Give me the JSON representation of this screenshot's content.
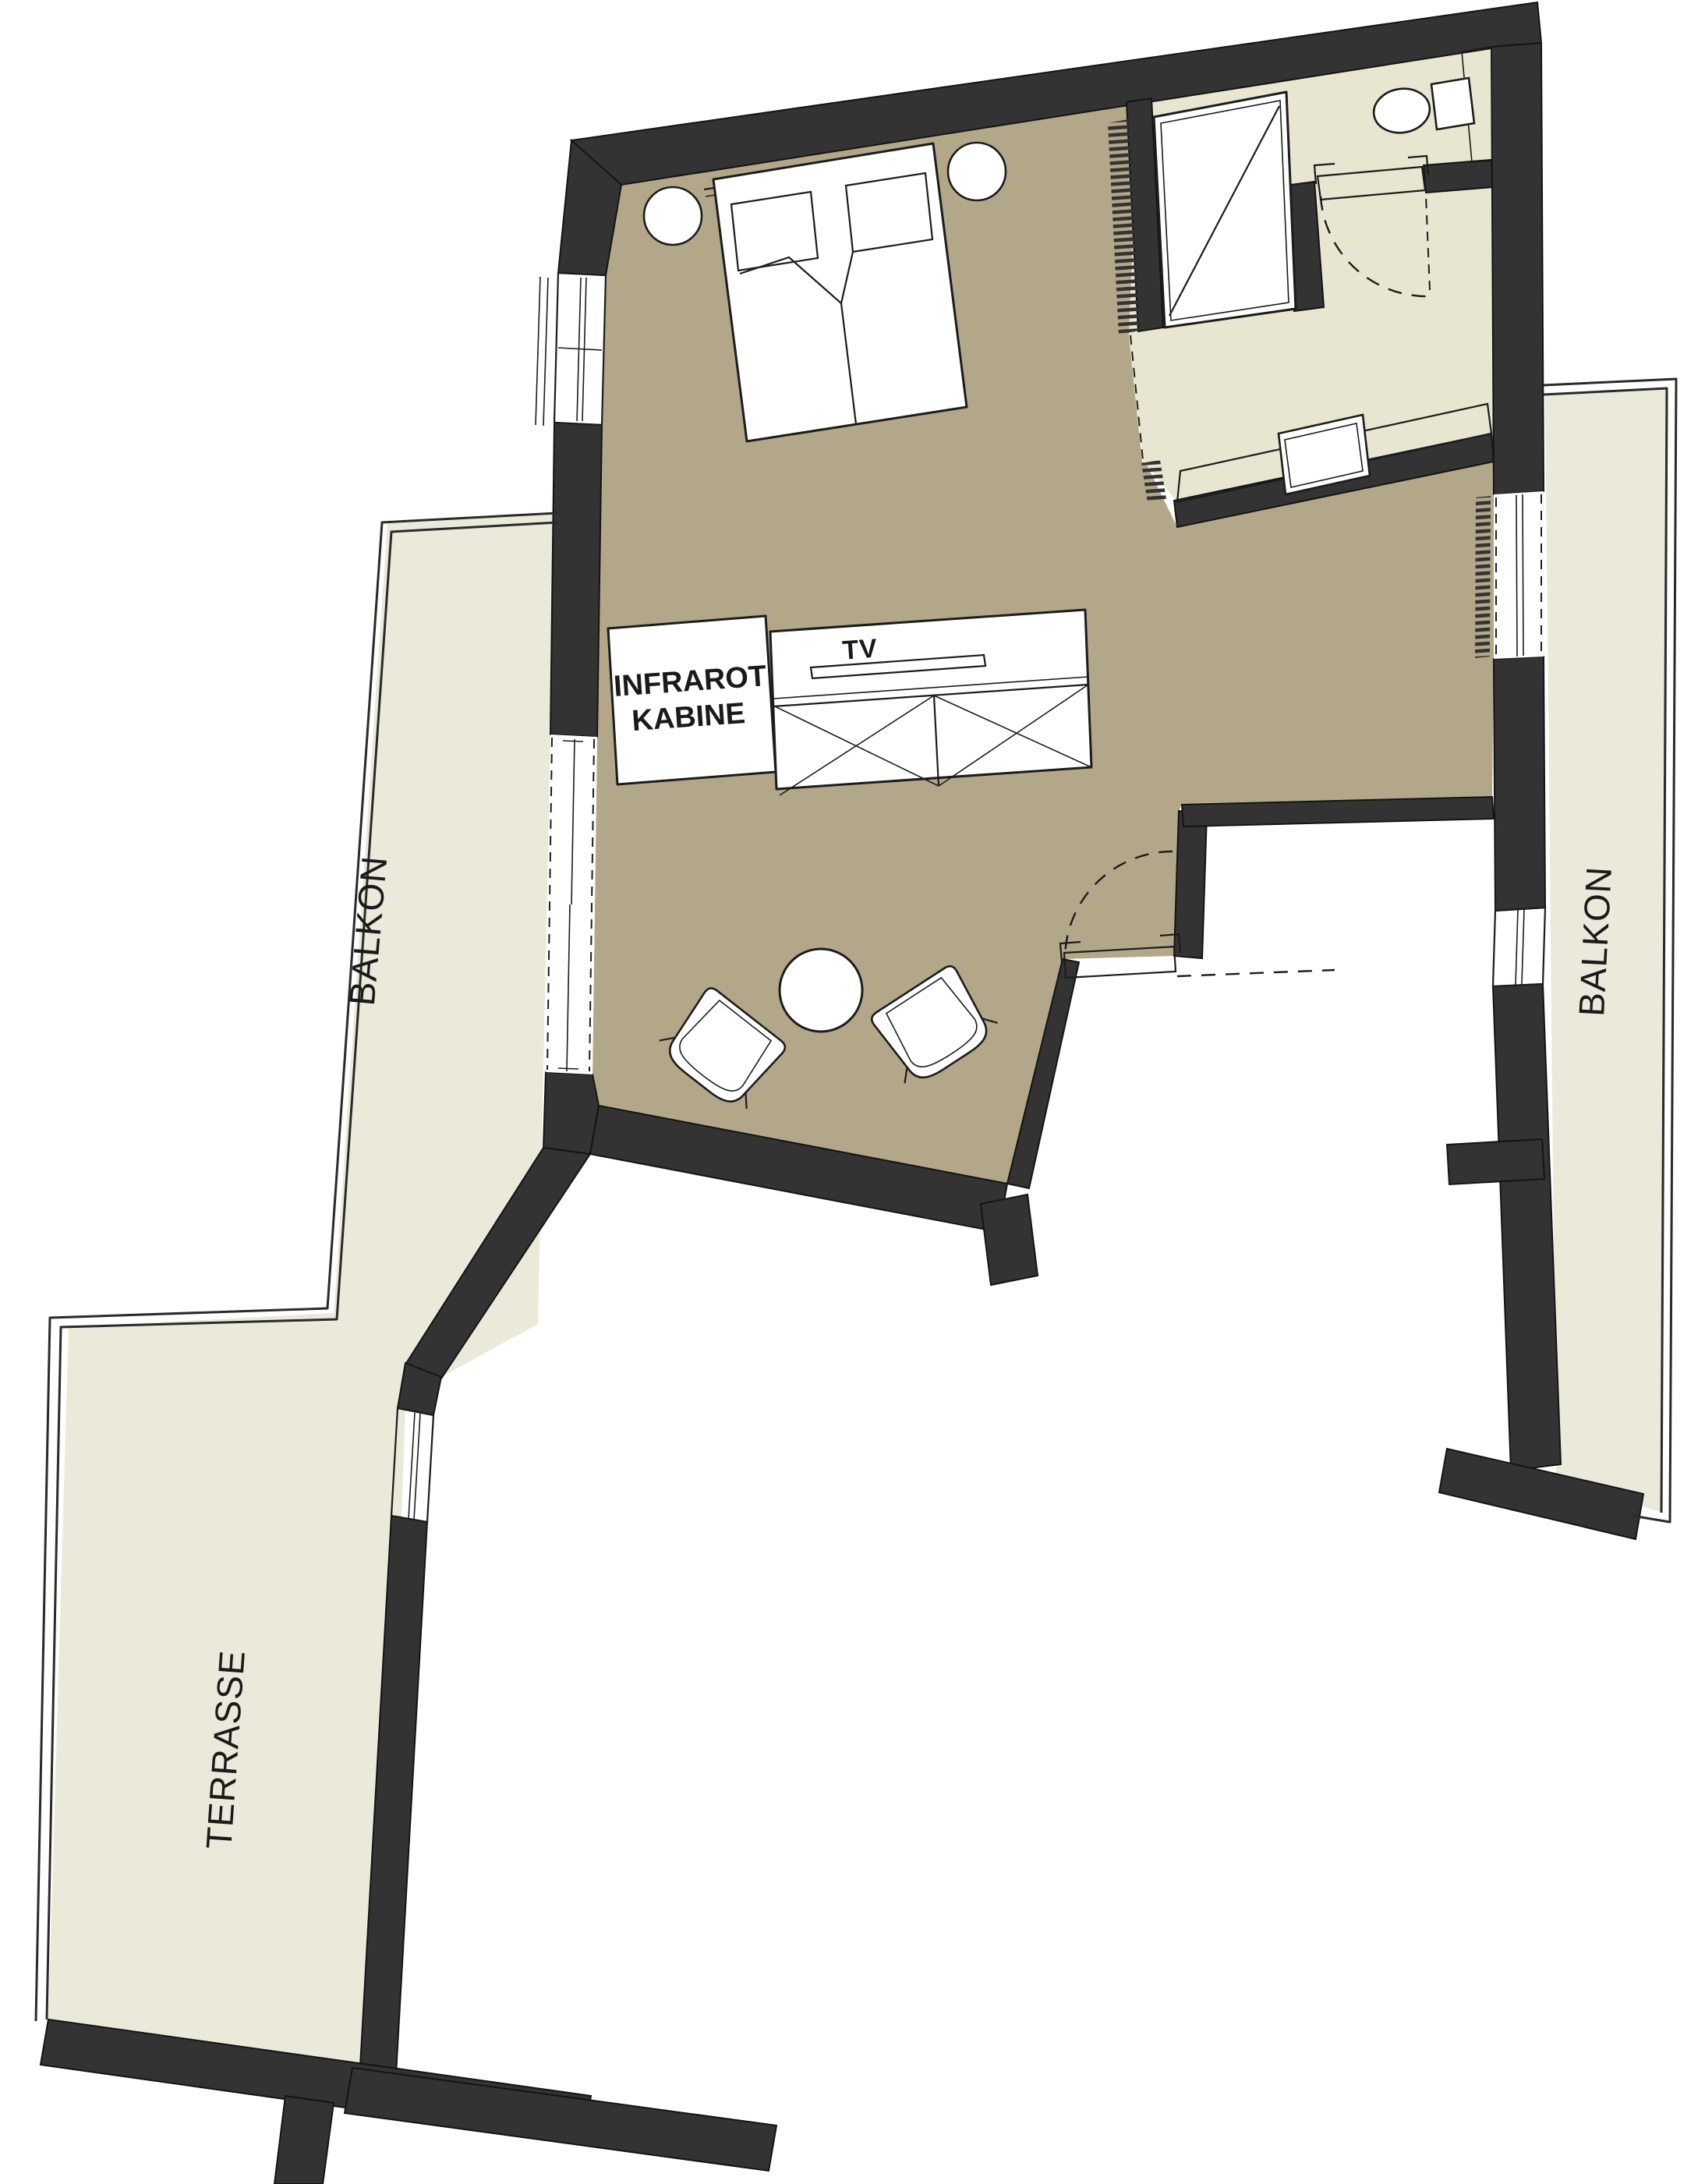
{
  "page": {
    "background": "#ffffff",
    "type": "architectural-floor-plan"
  },
  "colors": {
    "wall": "#333333",
    "outline": "#1c1c1c",
    "floor_main": "#b3a78a",
    "floor_bathroom": "#e8e5d0",
    "floor_outdoor": "#ebe9d9",
    "furniture": "#ffffff",
    "text": "#1a1a1a"
  },
  "labels": {
    "infrared_cabin": {
      "line1": "INFRAROT",
      "line2": "KABINE"
    },
    "tv": "TV",
    "balcony_left": "BALKON",
    "balcony_right": "BALKON",
    "terrace": "TERRASSE"
  },
  "symbols": [
    "double-bed",
    "pillow",
    "nightstand",
    "shower",
    "toilet",
    "vanity-sink",
    "wardrobe-x-box",
    "tv-panel",
    "infrared-cabin",
    "round-table",
    "armchair",
    "door-swing-arc",
    "sliding-door",
    "window-glass",
    "balcony-railing",
    "wall-hatch"
  ]
}
